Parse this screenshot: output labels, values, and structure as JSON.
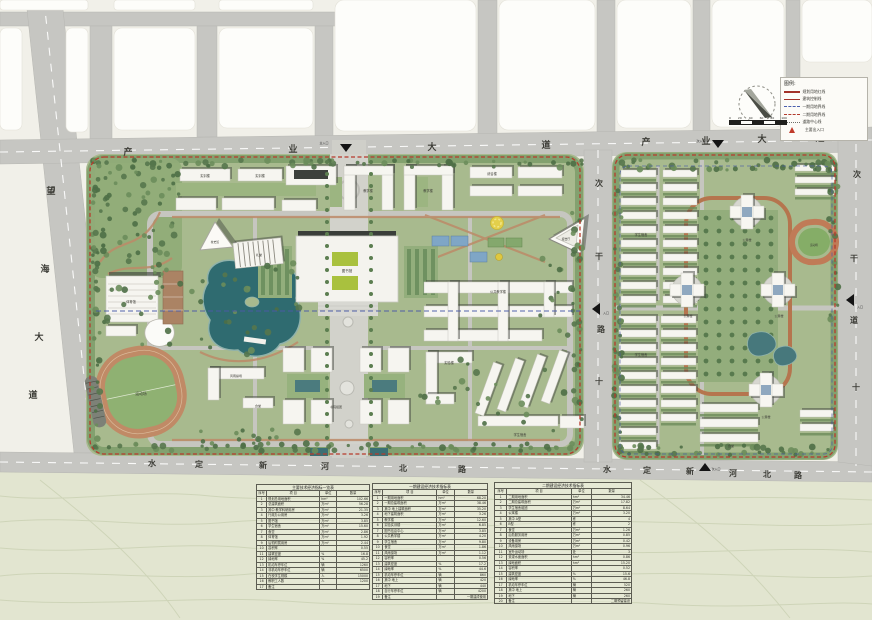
{
  "colors": {
    "boundary_red": "#b73a2c",
    "axis_blue": "#4a5aa6",
    "water": "#2f6b70",
    "track_tan": "#c08a66",
    "road_gray": "#c6c6c2",
    "campus_green": "#a8ba8e"
  },
  "legend": {
    "title": "图例:",
    "entries": [
      {
        "sample": "solid-thick",
        "label": "规划用地红线"
      },
      {
        "sample": "solid-thin",
        "label": "建筑控制线"
      },
      {
        "sample": "dash-blue",
        "label": "一期用地界线"
      },
      {
        "sample": "dash-red",
        "label": "二期用地界线"
      },
      {
        "sample": "dot-gray",
        "label": "道路中心线"
      },
      {
        "sample": "tri-red",
        "label": "主要出入口"
      }
    ]
  },
  "scale_bar": {
    "ticks": [
      "0",
      "20",
      "40",
      "60",
      "80",
      "100"
    ]
  },
  "map_labels": [
    {
      "t": "产",
      "x": 128,
      "y": 155,
      "s": 9,
      "b": 1
    },
    {
      "t": "业",
      "x": 293,
      "y": 152,
      "s": 9,
      "b": 1
    },
    {
      "t": "大",
      "x": 432,
      "y": 150,
      "s": 9,
      "b": 1
    },
    {
      "t": "道",
      "x": 546,
      "y": 148,
      "s": 9,
      "b": 1
    },
    {
      "t": "主入口",
      "x": 324,
      "y": 144,
      "s": 3,
      "c": "#333"
    },
    {
      "t": "产",
      "x": 646,
      "y": 145,
      "s": 9,
      "b": 1
    },
    {
      "t": "业",
      "x": 706,
      "y": 144,
      "s": 9,
      "b": 1
    },
    {
      "t": "大",
      "x": 762,
      "y": 142,
      "s": 9,
      "b": 1
    },
    {
      "t": "道",
      "x": 820,
      "y": 141,
      "s": 9,
      "b": 1
    },
    {
      "t": "次入口",
      "x": 701,
      "y": 142,
      "s": 3,
      "c": "#333"
    },
    {
      "t": "望",
      "x": 51,
      "y": 194,
      "s": 9,
      "b": 1
    },
    {
      "t": "海",
      "x": 45,
      "y": 272,
      "s": 9,
      "b": 1
    },
    {
      "t": "大",
      "x": 39,
      "y": 340,
      "s": 9,
      "b": 1
    },
    {
      "t": "道",
      "x": 33,
      "y": 398,
      "s": 9,
      "b": 1
    },
    {
      "t": "水",
      "x": 152,
      "y": 466,
      "s": 8,
      "b": 1
    },
    {
      "t": "定",
      "x": 199,
      "y": 467,
      "s": 8,
      "b": 1
    },
    {
      "t": "新",
      "x": 263,
      "y": 468,
      "s": 8,
      "b": 1
    },
    {
      "t": "河",
      "x": 325,
      "y": 469,
      "s": 8,
      "b": 1
    },
    {
      "t": "北",
      "x": 403,
      "y": 471,
      "s": 8,
      "b": 1
    },
    {
      "t": "路",
      "x": 462,
      "y": 472,
      "s": 8,
      "b": 1
    },
    {
      "t": "水",
      "x": 607,
      "y": 472,
      "s": 8,
      "b": 1
    },
    {
      "t": "定",
      "x": 647,
      "y": 473,
      "s": 8,
      "b": 1
    },
    {
      "t": "新",
      "x": 690,
      "y": 474,
      "s": 8,
      "b": 1
    },
    {
      "t": "河",
      "x": 733,
      "y": 476,
      "s": 8,
      "b": 1
    },
    {
      "t": "北",
      "x": 767,
      "y": 477,
      "s": 8,
      "b": 1
    },
    {
      "t": "路",
      "x": 798,
      "y": 478,
      "s": 8,
      "b": 1
    },
    {
      "t": "次入口",
      "x": 716,
      "y": 470,
      "s": 3,
      "c": "#333"
    },
    {
      "t": "次",
      "x": 857,
      "y": 177,
      "s": 8,
      "b": 1
    },
    {
      "t": "干",
      "x": 854,
      "y": 261,
      "s": 8,
      "b": 1
    },
    {
      "t": "道",
      "x": 854,
      "y": 323,
      "s": 8,
      "b": 1
    },
    {
      "t": "十",
      "x": 856,
      "y": 390,
      "s": 8,
      "b": 1
    },
    {
      "t": "次",
      "x": 599,
      "y": 186,
      "s": 8,
      "b": 1
    },
    {
      "t": "干",
      "x": 599,
      "y": 259,
      "s": 8,
      "b": 1
    },
    {
      "t": "路",
      "x": 601,
      "y": 332,
      "s": 8,
      "b": 1
    },
    {
      "t": "十",
      "x": 599,
      "y": 384,
      "s": 8,
      "b": 1
    },
    {
      "t": "入口",
      "x": 606,
      "y": 314,
      "s": 3,
      "c": "#333"
    },
    {
      "t": "入口",
      "x": 860,
      "y": 308,
      "s": 3,
      "c": "#333"
    },
    {
      "t": "实训楼",
      "x": 205,
      "y": 177,
      "s": 3.2
    },
    {
      "t": "实训楼",
      "x": 260,
      "y": 177,
      "s": 3.2
    },
    {
      "t": "教学楼",
      "x": 368,
      "y": 192,
      "s": 3.2
    },
    {
      "t": "教学楼",
      "x": 428,
      "y": 192,
      "s": 3.2
    },
    {
      "t": "综合楼",
      "x": 492,
      "y": 175,
      "s": 3.2
    },
    {
      "t": "校史馆",
      "x": 215,
      "y": 243,
      "s": 2.8
    },
    {
      "t": "报告厅",
      "x": 566,
      "y": 240,
      "s": 2.8
    },
    {
      "t": "礼堂",
      "x": 259,
      "y": 256,
      "s": 3
    },
    {
      "t": "图书馆",
      "x": 347,
      "y": 272,
      "s": 3.5
    },
    {
      "t": "体育馆",
      "x": 131,
      "y": 303,
      "s": 3.2
    },
    {
      "t": "运动场",
      "x": 141,
      "y": 395,
      "s": 3.8
    },
    {
      "t": "公共教学楼",
      "x": 498,
      "y": 293,
      "s": 3.2
    },
    {
      "t": "实验楼",
      "x": 449,
      "y": 364,
      "s": 3.2
    },
    {
      "t": "风雨操场",
      "x": 236,
      "y": 377,
      "s": 3
    },
    {
      "t": "食堂",
      "x": 258,
      "y": 407,
      "s": 3
    },
    {
      "t": "学生宿舍",
      "x": 520,
      "y": 436,
      "s": 3.2
    },
    {
      "t": "书院组团",
      "x": 336,
      "y": 408,
      "s": 3
    },
    {
      "t": "学生宿舍",
      "x": 641,
      "y": 236,
      "s": 3.2
    },
    {
      "t": "学生宿舍",
      "x": 641,
      "y": 356,
      "s": 3.2
    },
    {
      "t": "公寓楼",
      "x": 747,
      "y": 241,
      "s": 3
    },
    {
      "t": "公寓楼",
      "x": 688,
      "y": 317,
      "s": 3
    },
    {
      "t": "公寓楼",
      "x": 779,
      "y": 317,
      "s": 3
    },
    {
      "t": "公寓楼",
      "x": 766,
      "y": 418,
      "s": 3
    },
    {
      "t": "食堂",
      "x": 731,
      "y": 447,
      "s": 3
    },
    {
      "t": "运动场",
      "x": 814,
      "y": 246,
      "s": 2.6
    }
  ],
  "tables": [
    {
      "x": 256,
      "y": 484,
      "w": 114,
      "title": "主要技术经济指标一览表",
      "cols": [
        "序号",
        "项 目",
        "单位",
        "数量"
      ],
      "rows": [
        [
          "1",
          "规划总用地面积",
          "hm²",
          "102.66"
        ],
        [
          "2",
          "总建筑面积",
          "万m²",
          "56.28"
        ],
        [
          "3",
          "其中 教学科研用房",
          "万m²",
          "21.35"
        ],
        [
          "4",
          "行政办公用房",
          "万m²",
          "3.26"
        ],
        [
          "5",
          "图书馆",
          "万m²",
          "3.85"
        ],
        [
          "6",
          "学生宿舍",
          "万m²",
          "15.60"
        ],
        [
          "7",
          "食堂",
          "万m²",
          "2.86"
        ],
        [
          "8",
          "体育馆",
          "万m²",
          "1.92"
        ],
        [
          "9",
          "后勤附属用房",
          "万m²",
          "2.44"
        ],
        [
          "10",
          "容积率",
          "",
          "0.55"
        ],
        [
          "11",
          "建筑密度",
          "%",
          "16.8"
        ],
        [
          "12",
          "绿地率",
          "%",
          "45.2"
        ],
        [
          "13",
          "机动车停车位",
          "辆",
          "1260"
        ],
        [
          "14",
          "非机动车停车位",
          "辆",
          "6500"
        ],
        [
          "15",
          "在校学生规模",
          "人",
          "15000"
        ],
        [
          "16",
          "教职工人数",
          "人",
          "1200"
        ],
        [
          "17",
          "备注",
          "",
          ""
        ]
      ]
    },
    {
      "x": 372,
      "y": 483,
      "w": 116,
      "title": "一期建设经济技术指标表",
      "cols": [
        "序号",
        "项 目",
        "单位",
        "数量"
      ],
      "rows": [
        [
          "1",
          "一期用地面积",
          "hm²",
          "68.20"
        ],
        [
          "2",
          "一期总建筑面积",
          "万m²",
          "38.46"
        ],
        [
          "3",
          "其中 地上建筑面积",
          "万m²",
          "35.20"
        ],
        [
          "4",
          "地下建筑面积",
          "万m²",
          "3.26"
        ],
        [
          "5",
          "教学楼",
          "万m²",
          "12.60"
        ],
        [
          "6",
          "实验实训楼",
          "万m²",
          "6.85"
        ],
        [
          "7",
          "图书信息中心",
          "万m²",
          "3.85"
        ],
        [
          "8",
          "公共教学楼",
          "万m²",
          "4.20"
        ],
        [
          "9",
          "学生宿舍",
          "万m²",
          "9.80"
        ],
        [
          "10",
          "食堂",
          "万m²",
          "1.86"
        ],
        [
          "11",
          "风雨操场",
          "万m²",
          "1.12"
        ],
        [
          "12",
          "容积率",
          "",
          "0.56"
        ],
        [
          "13",
          "建筑密度",
          "%",
          "17.2"
        ],
        [
          "14",
          "绿地率",
          "%",
          "44.6"
        ],
        [
          "15",
          "机动车停车位",
          "辆",
          "860"
        ],
        [
          "16",
          "其中 地上",
          "辆",
          "420"
        ],
        [
          "17",
          "地下",
          "辆",
          "440"
        ],
        [
          "18",
          "自行车停车位",
          "辆",
          "4200"
        ],
        [
          "19",
          "备注",
          "",
          "一期建成使用"
        ]
      ]
    },
    {
      "x": 494,
      "y": 482,
      "w": 138,
      "title": "二期建设经济技术指标表",
      "cols": [
        "序号",
        "项 目",
        "单位",
        "数量"
      ],
      "rows": [
        [
          "1",
          "二期用地面积",
          "hm²",
          "34.46"
        ],
        [
          "2",
          "二期总建筑面积",
          "万m²",
          "17.82"
        ],
        [
          "3",
          "学生宿舍组团",
          "万m²",
          "8.64"
        ],
        [
          "4",
          "公寓楼",
          "万m²",
          "3.20"
        ],
        [
          "5",
          "其中 A型",
          "栋",
          "4"
        ],
        [
          "6",
          "B型",
          "栋",
          "2"
        ],
        [
          "7",
          "食堂",
          "万m²",
          "1.26"
        ],
        [
          "8",
          "后勤服务用房",
          "万m²",
          "0.85"
        ],
        [
          "9",
          "设备用房",
          "万m²",
          "0.42"
        ],
        [
          "10",
          "风雨操场",
          "万m²",
          "0.96"
        ],
        [
          "11",
          "室外运动场",
          "处",
          "3"
        ],
        [
          "12",
          "景观水面面积",
          "hm²",
          "0.86"
        ],
        [
          "13",
          "绿地面积",
          "hm²",
          "15.20"
        ],
        [
          "14",
          "容积率",
          "",
          "0.52"
        ],
        [
          "15",
          "建筑密度",
          "%",
          "15.6"
        ],
        [
          "16",
          "绿地率",
          "%",
          "46.8"
        ],
        [
          "17",
          "机动车停车位",
          "辆",
          "520"
        ],
        [
          "18",
          "其中 地上",
          "辆",
          "260"
        ],
        [
          "19",
          "地下",
          "辆",
          "260"
        ],
        [
          "20",
          "备注",
          "",
          "二期预留建设"
        ]
      ]
    }
  ]
}
